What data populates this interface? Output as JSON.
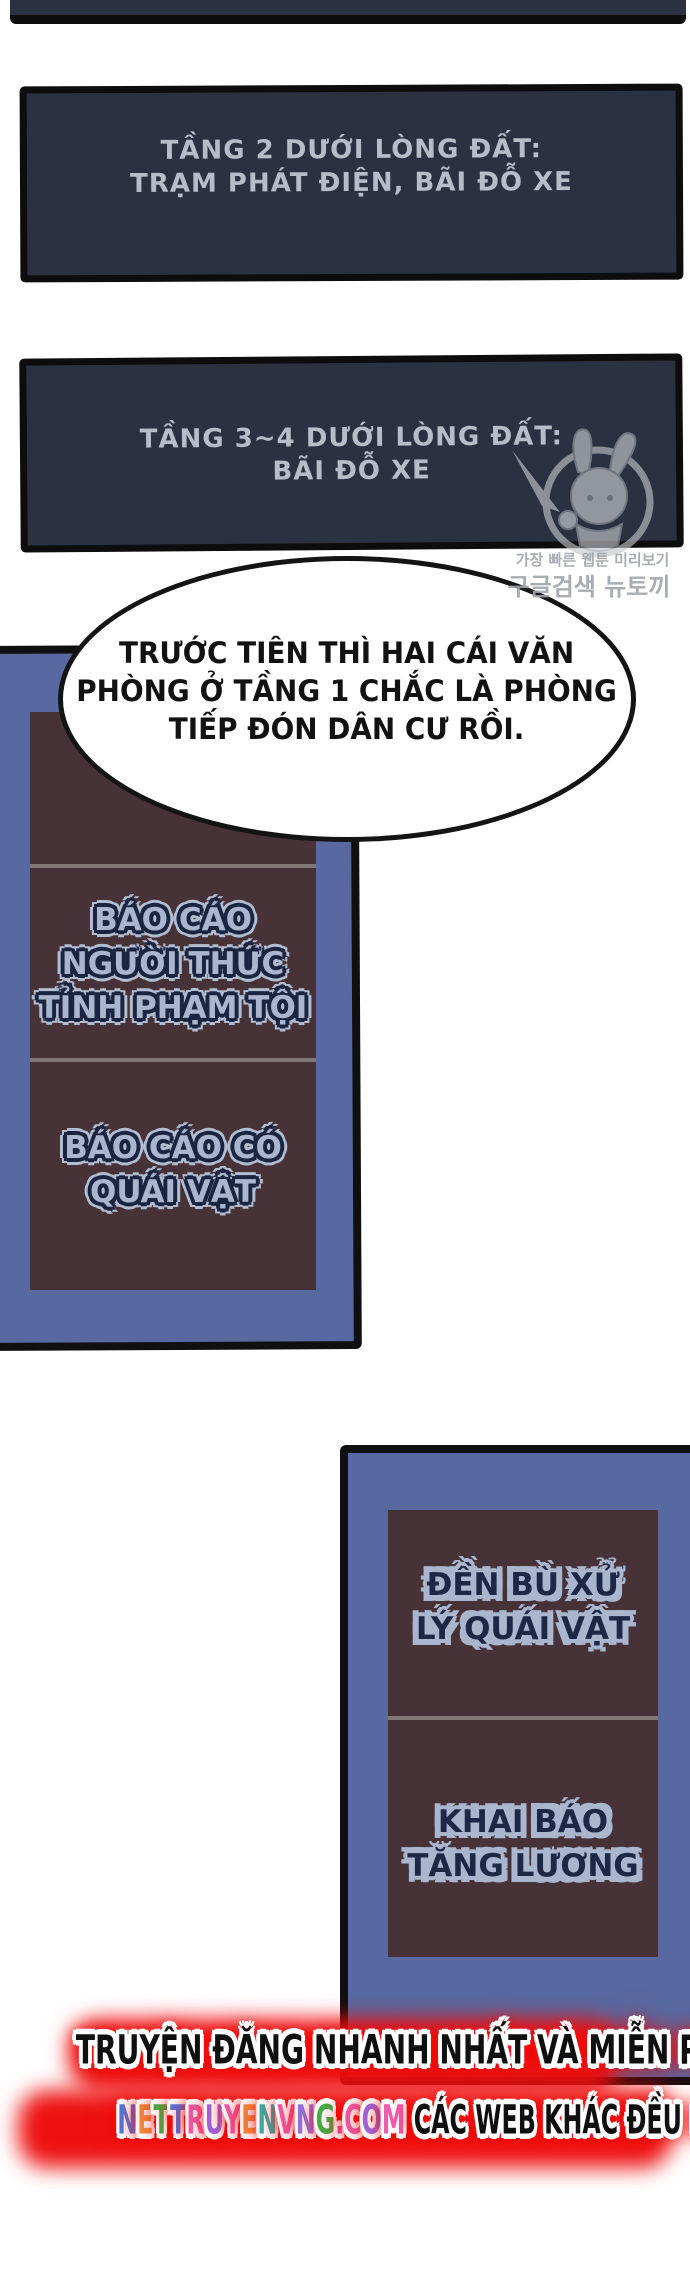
{
  "panel_floor2": {
    "line1": "TẦNG 2 DƯỚI LÒNG ĐẤT:",
    "line2": "TRẠM PHÁT ĐIỆN, BÃI ĐỖ XE"
  },
  "panel_floor34": {
    "line1": "TẦNG 3~4 DƯỚI LÒNG ĐẤT:",
    "line2": "BÃI ĐỖ XE"
  },
  "watermark": {
    "character": "bunny-girl-mascot",
    "line1": "가장 빠른 웹툰 미리보기",
    "line2": "구글검색 뉴토끼"
  },
  "speech_bubble": {
    "line1": "TRƯỚC TIÊN THÌ HAI CÁI VĂN",
    "line2": "PHÒNG Ở TẦNG 1 CHẮC LÀ PHÒNG",
    "line3": "TIẾP ĐÓN DÂN CƯ RỒI."
  },
  "left_board": {
    "sign_report_awakener": {
      "line1": "BÁO CÁO",
      "line2": "NGƯỜI THỨC",
      "line3": "TỈNH PHẠM TỘI"
    },
    "sign_report_monster": {
      "line1": "BÁO CÁO CÓ",
      "line2": "QUÁI VẬT"
    }
  },
  "right_board": {
    "sign_monster_compensation": {
      "line1": "ĐỀN BÙ XỬ",
      "line2": "LÝ QUÁI VẬT"
    },
    "sign_salary_report": {
      "line1": "KHAI BÁO",
      "line2": "TĂNG LƯƠNG"
    }
  },
  "footer": {
    "line1": "TRUYỆN ĐĂNG NHANH NHẤT VÀ MIỄN PHÍ TẠI",
    "site": "NETTRUYENVNG.COM",
    "line2_rest": "CÁC WEB KHÁC ĐỀU LÀ ĂN CẮP",
    "site_letter_colors": [
      "#4f7be0",
      "#f09040",
      "#45b04a",
      "#4f7be0",
      "#ec5fb0",
      "#9a6ae0",
      "#ec5fb0",
      "#f09040",
      "#38b0a8",
      "#ec5fb0",
      "#8a7ae8",
      "#45b04a",
      "#ec4fa0",
      "#ec5fb0",
      "#9a6ae0",
      "#ec5fb0"
    ],
    "glow_color": "#ee1111"
  },
  "colors": {
    "panel_dark": "#2a3140",
    "board_blue": "#5769a0",
    "sign_maroon": "#473238",
    "sign_text_light": "#a9b6ce",
    "sign_text_dark": "#1d2844"
  }
}
